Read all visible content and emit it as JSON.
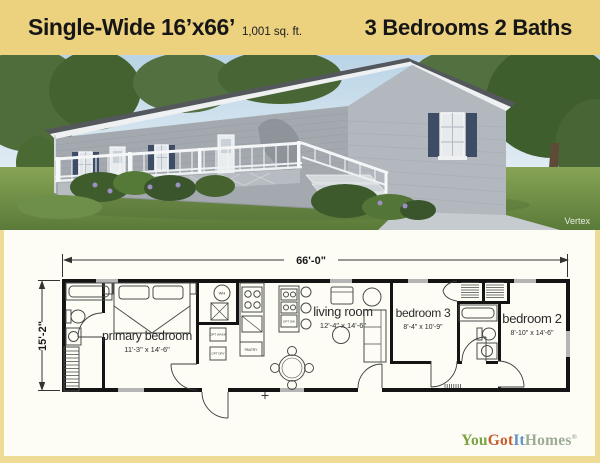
{
  "header": {
    "title": "Single-Wide 16’x66’",
    "sqft": "1,001 sq. ft.",
    "beds_baths": "3 Bedrooms 2 Baths"
  },
  "photo": {
    "watermark": "Vertex",
    "description": "Gray single-wide manufactured home with white porch railing and steps, dark blue shutters, lawn and trees"
  },
  "floorplan": {
    "overall_width": "66'-0\"",
    "overall_depth": "15'-2\"",
    "rooms": [
      {
        "name": "primary bedroom",
        "dims": "11'-3\" x 14'-6\""
      },
      {
        "name": "living room",
        "dims": "12'-4\" x 14'-6\""
      },
      {
        "name": "bedroom 3",
        "dims": "8'-4\" x 10'-9\""
      },
      {
        "name": "bedroom 2",
        "dims": "8'-10\" x 14'-6\""
      }
    ],
    "labels": {
      "wh": "WH",
      "pantry": "PANTRY",
      "opt_wash": "OPT WASH",
      "opt_dry": "OPT DRY",
      "opt_dw": "OPT DW"
    }
  },
  "logo": {
    "segments": [
      {
        "text": "You",
        "color": "#7ca341"
      },
      {
        "text": "Got",
        "color": "#c65c30"
      },
      {
        "text": "It",
        "color": "#5d91c4"
      },
      {
        "text": "Homes",
        "color": "#9cab96"
      }
    ],
    "mark": "®"
  },
  "colors": {
    "header_bg": "#ecd27e",
    "frame_bg": "#eedc96",
    "plan_bg": "#fdfdf6",
    "shutters": "#3e4d66",
    "siding": "#a4a9af"
  }
}
